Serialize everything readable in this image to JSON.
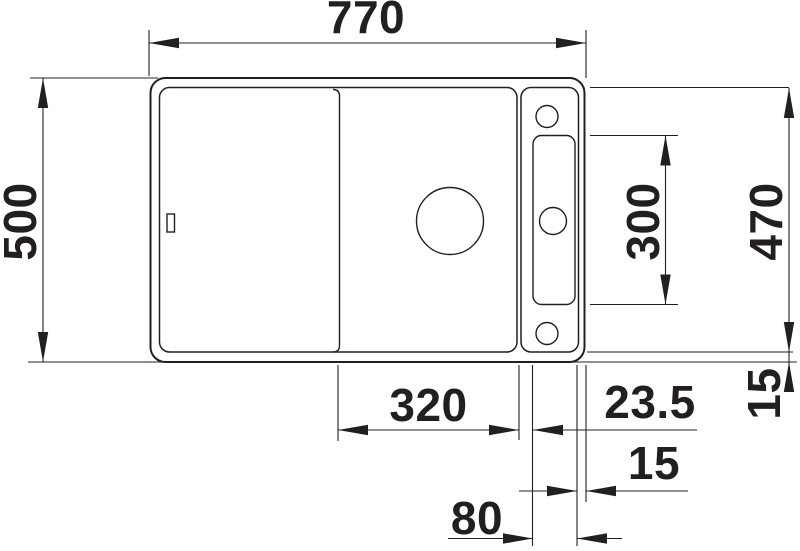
{
  "drawing": {
    "kind": "sink-top-view-technical-drawing",
    "colors": {
      "line": "#231f20",
      "background": "#ffffff"
    }
  },
  "dims": {
    "d770": "770",
    "d500": "500",
    "d470": "470",
    "d300": "300",
    "d320": "320",
    "d23_5": "23.5",
    "d15_right": "15",
    "d15_bottom": "15",
    "d80": "80"
  }
}
